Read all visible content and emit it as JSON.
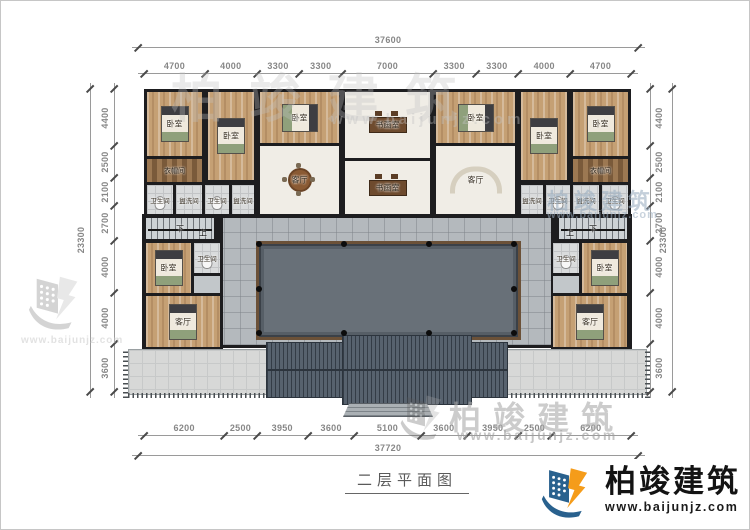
{
  "meta": {
    "title": "二层平面图"
  },
  "branding": {
    "name": "柏竣建筑",
    "url": "www.baijunjz.com"
  },
  "colors": {
    "wall": "#1d1d1f",
    "wood_floor": "#c5a074",
    "courtyard": "#687078",
    "walkway": "#b4b9bd",
    "roof": "#57626e",
    "logo_blue": "#29618e",
    "logo_orange": "#f59c1a"
  },
  "dimensions": {
    "top": {
      "total": "37600",
      "segments": [
        "4700",
        "4000",
        "3300",
        "3300",
        "7000",
        "3300",
        "3300",
        "4000",
        "4700"
      ]
    },
    "bottom": {
      "total": "37720",
      "segments": [
        "6200",
        "2500",
        "3950",
        "3600",
        "5100",
        "3600",
        "3950",
        "2500",
        "6200"
      ]
    },
    "left": {
      "total": "23300",
      "segments": [
        "4400",
        "2500",
        "2100",
        "2700",
        "4000",
        "4000",
        "3600"
      ]
    },
    "right": {
      "total": "23300",
      "segments": [
        "4400",
        "2500",
        "2100",
        "2700",
        "4000",
        "4000",
        "3600"
      ]
    }
  },
  "stair_labels": {
    "down": "下",
    "up": "上"
  },
  "rooms": [
    {
      "name": "bedroom-nw-1",
      "label": "卧室",
      "type": "wood",
      "furn": "bed",
      "x": 146,
      "y": 91,
      "w": 55,
      "h": 64
    },
    {
      "name": "bedroom-nw-2",
      "label": "卧室",
      "type": "wood",
      "furn": "bed",
      "x": 207,
      "y": 91,
      "w": 46,
      "h": 88
    },
    {
      "name": "bedroom-nw-3",
      "label": "卧室",
      "type": "wood",
      "furn": "bed-h",
      "x": 259,
      "y": 91,
      "w": 79,
      "h": 51
    },
    {
      "name": "art-studio-north",
      "label": "书画室",
      "type": "light",
      "furn": "desk",
      "x": 344,
      "y": 91,
      "w": 85,
      "h": 66
    },
    {
      "name": "bedroom-ne-3",
      "label": "卧室",
      "type": "wood",
      "furn": "bed-h",
      "x": 435,
      "y": 91,
      "w": 79,
      "h": 51
    },
    {
      "name": "bedroom-ne-2",
      "label": "卧室",
      "type": "wood",
      "furn": "bed",
      "x": 520,
      "y": 91,
      "w": 46,
      "h": 88
    },
    {
      "name": "bedroom-ne-1",
      "label": "卧室",
      "type": "wood",
      "furn": "bed",
      "x": 572,
      "y": 91,
      "w": 55,
      "h": 64
    },
    {
      "name": "cloakroom-west",
      "label": "衣帽间",
      "type": "shelf",
      "x": 146,
      "y": 158,
      "w": 55,
      "h": 23
    },
    {
      "name": "cloakroom-east",
      "label": "衣帽间",
      "type": "shelf",
      "x": 572,
      "y": 158,
      "w": 55,
      "h": 23
    },
    {
      "name": "living-room-west",
      "label": "客厅",
      "type": "light",
      "furn": "table",
      "x": 259,
      "y": 145,
      "w": 79,
      "h": 68
    },
    {
      "name": "art-studio-south",
      "label": "书画室",
      "type": "light",
      "furn": "desk",
      "x": 344,
      "y": 160,
      "w": 85,
      "h": 53
    },
    {
      "name": "living-room-east",
      "label": "客厅",
      "type": "light",
      "furn": "sofa",
      "x": 435,
      "y": 145,
      "w": 79,
      "h": 68
    },
    {
      "name": "bathroom-w1",
      "label": "卫生间",
      "type": "tile",
      "furn": "wc",
      "x": 146,
      "y": 184,
      "w": 26,
      "h": 29
    },
    {
      "name": "washroom-w1",
      "label": "盥洗间",
      "type": "tile",
      "x": 175,
      "y": 184,
      "w": 26,
      "h": 29
    },
    {
      "name": "bathroom-w2",
      "label": "卫生间",
      "type": "tile",
      "furn": "wc",
      "x": 204,
      "y": 184,
      "w": 24,
      "h": 29
    },
    {
      "name": "washroom-w2",
      "label": "盥洗间",
      "type": "tile",
      "x": 231,
      "y": 184,
      "w": 22,
      "h": 29
    },
    {
      "name": "washroom-e2",
      "label": "盥洗间",
      "type": "tile",
      "x": 520,
      "y": 184,
      "w": 22,
      "h": 29
    },
    {
      "name": "bathroom-e2",
      "label": "卫生间",
      "type": "tile",
      "furn": "wc",
      "x": 545,
      "y": 184,
      "w": 24,
      "h": 29
    },
    {
      "name": "washroom-e1",
      "label": "盥洗间",
      "type": "tile",
      "x": 572,
      "y": 184,
      "w": 26,
      "h": 29
    },
    {
      "name": "bathroom-e1",
      "label": "卫生间",
      "type": "tile",
      "furn": "wc",
      "x": 601,
      "y": 184,
      "w": 26,
      "h": 29
    },
    {
      "name": "stair-west",
      "label": "下",
      "type": "stair",
      "x": 145,
      "y": 217,
      "w": 68,
      "h": 21
    },
    {
      "name": "stair-west-up",
      "label": "上",
      "type": "plain",
      "x": 196,
      "y": 227,
      "w": 12,
      "h": 10
    },
    {
      "name": "stair-east",
      "label": "下",
      "type": "stair",
      "x": 558,
      "y": 217,
      "w": 68,
      "h": 21
    },
    {
      "name": "stair-east-up",
      "label": "上",
      "type": "plain",
      "x": 563,
      "y": 227,
      "w": 12,
      "h": 10
    },
    {
      "name": "bedroom-west-wing",
      "label": "卧室",
      "type": "wood",
      "furn": "bed",
      "x": 145,
      "y": 242,
      "w": 45,
      "h": 50
    },
    {
      "name": "bathroom-west-wing",
      "label": "卫生间",
      "type": "tile",
      "furn": "wc",
      "x": 193,
      "y": 242,
      "w": 26,
      "h": 30
    },
    {
      "name": "hall-west-wing",
      "label": "",
      "type": "walk",
      "x": 193,
      "y": 275,
      "w": 26,
      "h": 17
    },
    {
      "name": "living-west-wing",
      "label": "客厅",
      "type": "wood",
      "furn": "bed",
      "x": 145,
      "y": 295,
      "w": 74,
      "h": 51
    },
    {
      "name": "bathroom-east-wing",
      "label": "卫生间",
      "type": "tile",
      "furn": "wc",
      "x": 552,
      "y": 242,
      "w": 26,
      "h": 30
    },
    {
      "name": "hall-east-wing",
      "label": "",
      "type": "walk",
      "x": 552,
      "y": 275,
      "w": 26,
      "h": 17
    },
    {
      "name": "bedroom-east-wing",
      "label": "卧室",
      "type": "wood",
      "furn": "bed",
      "x": 581,
      "y": 242,
      "w": 45,
      "h": 50
    },
    {
      "name": "living-east-wing",
      "label": "客厅",
      "type": "wood",
      "furn": "bed",
      "x": 552,
      "y": 295,
      "w": 74,
      "h": 51
    }
  ],
  "watermarks": [
    {
      "text": "柏竣建筑",
      "x": 170,
      "y": 56,
      "size": 52,
      "ls": 26,
      "color": "#c2c2c2",
      "opacity": 0.33
    },
    {
      "text": "www.baijunjz.com",
      "x": 330,
      "y": 110,
      "size": 15,
      "ls": 4,
      "color": "#c4c4c4",
      "opacity": 0.4
    },
    {
      "text": "柏竣建筑",
      "x": 546,
      "y": 183,
      "size": 22,
      "ls": 5,
      "color": "#9db0c2",
      "opacity": 0.6
    },
    {
      "text": "www.baijunjz.com",
      "x": 546,
      "y": 208,
      "size": 11,
      "ls": 1,
      "color": "#9db0c2",
      "opacity": 0.55
    },
    {
      "text": "柏竣建筑",
      "x": 448,
      "y": 392,
      "size": 32,
      "ls": 12,
      "color": "#ababab",
      "opacity": 0.6
    },
    {
      "text": "www.baijunjz.com",
      "x": 456,
      "y": 426,
      "size": 14,
      "ls": 2.5,
      "color": "#a0a0a0",
      "opacity": 0.6
    },
    {
      "text": "www.baijunjz.com",
      "x": 20,
      "y": 334,
      "size": 10,
      "ls": 1,
      "color": "#c6c6c6",
      "opacity": 0.5
    }
  ]
}
